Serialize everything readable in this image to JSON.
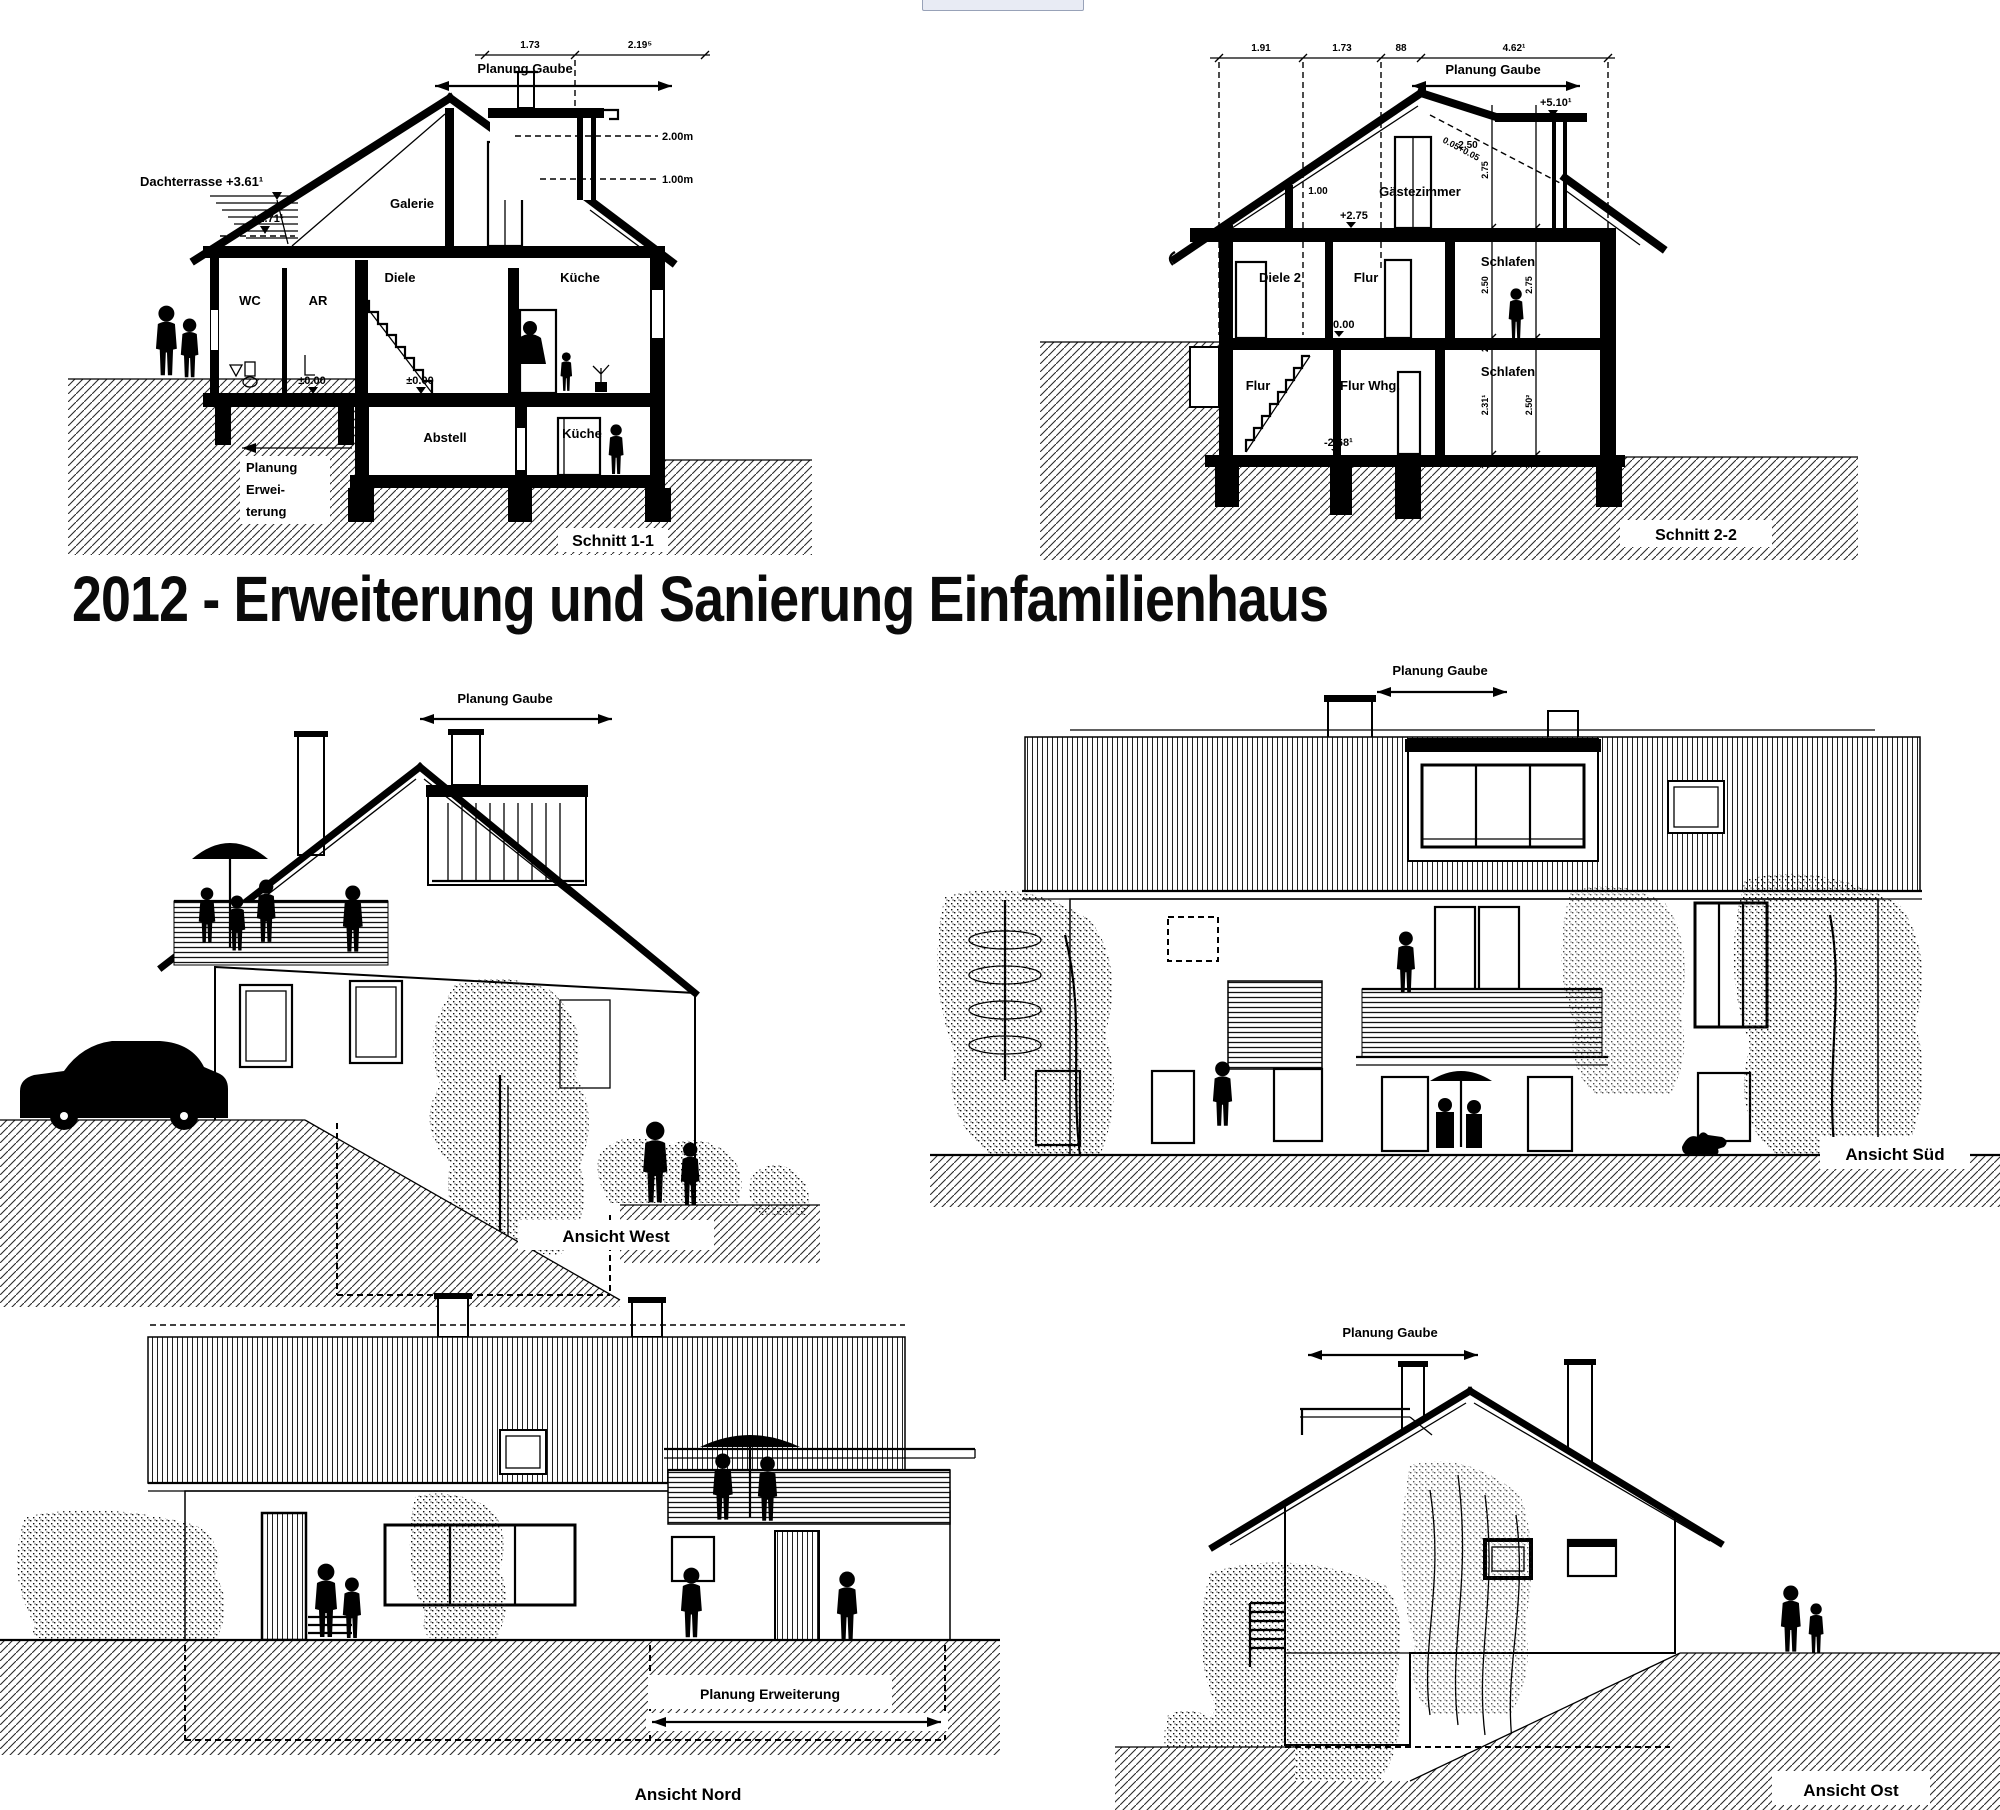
{
  "colors": {
    "ink": "#000000",
    "paper": "#ffffff",
    "widget_fill": "#e8ebf4",
    "widget_border": "#98a2b8"
  },
  "title": {
    "text": "2012 - Erweiterung und Sanierung Einfamilienhaus"
  },
  "schnitt_1_1": {
    "caption": "Schnitt 1-1",
    "planung_gaube_label": "Planung Gaube",
    "dim_1_73": "1.73",
    "dim_2_19": "2.19⁵",
    "dachterrasse_label": "Dachterrasse +3.61¹",
    "level_plus_2_71": "+2.71¹",
    "level_zero_left": "±0.00",
    "level_zero_mid": "±0.00",
    "line_2_00m": "2.00m",
    "line_1_00m": "1.00m",
    "room_wc": "WC",
    "room_ar": "AR",
    "room_galerie": "Galerie",
    "room_diele": "Diele",
    "room_kueche_eg": "Küche",
    "room_abstell": "Abstell",
    "room_kueche_kg": "Küche",
    "planung_erweiterung_1": "Planung",
    "planung_erweiterung_2": "Erwei-",
    "planung_erweiterung_3": "terung"
  },
  "schnitt_2_2": {
    "caption": "Schnitt 2-2",
    "planung_gaube_label": "Planung Gaube",
    "dim_1_91": "1.91",
    "dim_1_73": "1.73",
    "dim_88": "88",
    "dim_4_62": "4.62¹",
    "level_plus_5_10": "+5.10¹",
    "level_plus_2_75": "+2.75",
    "level_zero": "±0.00",
    "level_minus_2_68": "-2.68¹",
    "roof_slope_note": "0.05+0.05",
    "dim_knee_1_00": "1.00",
    "dim_dormer_2_50": "2.50",
    "vdim_attic_2_75": "2.75",
    "vdim_og_2_50": "2.50",
    "vdim_og_2_75": "2.75",
    "vdim_ug_2_31": "2.31¹",
    "vdim_ug_2_50": "2.50²",
    "slab_25": "25",
    "slab_27": "27",
    "slab_19a": "19",
    "slab_19b": "19",
    "room_gaestezimmer": "Gästezimmer",
    "room_diele_2": "Diele 2",
    "room_flur_og": "Flur",
    "room_schlafen_og": "Schlafen",
    "room_flur_ug": "Flur",
    "room_flur_whg": "Flur Whg.",
    "room_schlafen_ug": "Schlafen"
  },
  "ansicht_west": {
    "caption": "Ansicht West",
    "planung_gaube_label": "Planung Gaube"
  },
  "ansicht_sued": {
    "caption": "Ansicht Süd",
    "planung_gaube_label": "Planung Gaube"
  },
  "ansicht_nord": {
    "caption": "Ansicht Nord",
    "planung_erweiterung_label": "Planung Erweiterung"
  },
  "ansicht_ost": {
    "caption": "Ansicht Ost",
    "planung_gaube_label": "Planung Gaube"
  }
}
